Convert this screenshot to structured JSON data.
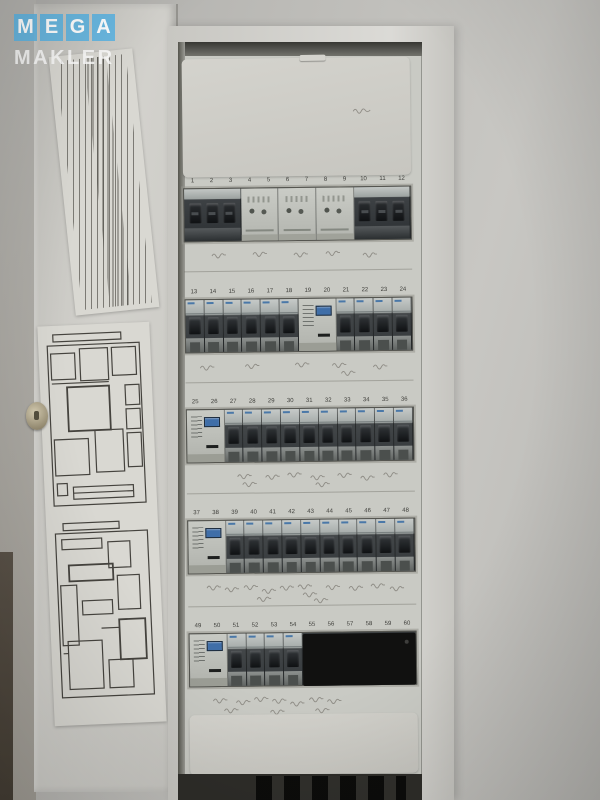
{
  "watermark": {
    "line1": "MEGA",
    "line2": "MAKLER",
    "accent_color": "#61b5e2"
  },
  "panel": {
    "description": "open electrical distribution board with five DIN rows of circuit breakers and meter modules, door with circuit schedule and floor plans",
    "colors": {
      "display_blue": "#3f6ea8",
      "breaker_dark": "#2e3234",
      "cover_gray": "#cfceca"
    },
    "rows": [
      {
        "numbers": [
          "1",
          "2",
          "3",
          "4",
          "5",
          "6",
          "7",
          "8",
          "9",
          "10",
          "11",
          "12"
        ],
        "modules": [
          {
            "type": "breaker3",
            "span": 3
          },
          {
            "type": "meter",
            "span": 2
          },
          {
            "type": "meter",
            "span": 2
          },
          {
            "type": "meter",
            "span": 2
          },
          {
            "type": "breaker3",
            "span": 3
          }
        ]
      },
      {
        "numbers": [
          "13",
          "14",
          "15",
          "16",
          "17",
          "18",
          "19",
          "20",
          "21",
          "22",
          "23",
          "24"
        ],
        "modules": [
          {
            "type": "breaker",
            "span": 1
          },
          {
            "type": "breaker",
            "span": 1
          },
          {
            "type": "breaker",
            "span": 1
          },
          {
            "type": "breaker",
            "span": 1
          },
          {
            "type": "breaker",
            "span": 1
          },
          {
            "type": "breaker",
            "span": 1
          },
          {
            "type": "meter_display",
            "span": 2
          },
          {
            "type": "breaker",
            "span": 1
          },
          {
            "type": "breaker",
            "span": 1
          },
          {
            "type": "breaker",
            "span": 1
          },
          {
            "type": "breaker",
            "span": 1
          }
        ]
      },
      {
        "numbers": [
          "25",
          "26",
          "27",
          "28",
          "29",
          "30",
          "31",
          "32",
          "33",
          "34",
          "35",
          "36"
        ],
        "modules": [
          {
            "type": "meter_display",
            "span": 2
          },
          {
            "type": "breaker",
            "span": 1
          },
          {
            "type": "breaker",
            "span": 1
          },
          {
            "type": "breaker",
            "span": 1
          },
          {
            "type": "breaker",
            "span": 1
          },
          {
            "type": "breaker",
            "span": 1
          },
          {
            "type": "breaker",
            "span": 1
          },
          {
            "type": "breaker",
            "span": 1
          },
          {
            "type": "breaker",
            "span": 1
          },
          {
            "type": "breaker",
            "span": 1
          },
          {
            "type": "breaker",
            "span": 1
          }
        ]
      },
      {
        "numbers": [
          "37",
          "38",
          "39",
          "40",
          "41",
          "42",
          "43",
          "44",
          "45",
          "46",
          "47",
          "48"
        ],
        "modules": [
          {
            "type": "meter_display",
            "span": 2
          },
          {
            "type": "breaker",
            "span": 1
          },
          {
            "type": "breaker",
            "span": 1
          },
          {
            "type": "breaker",
            "span": 1
          },
          {
            "type": "breaker",
            "span": 1
          },
          {
            "type": "breaker",
            "span": 1
          },
          {
            "type": "breaker",
            "span": 1
          },
          {
            "type": "breaker",
            "span": 1
          },
          {
            "type": "breaker",
            "span": 1
          },
          {
            "type": "breaker",
            "span": 1
          },
          {
            "type": "breaker",
            "span": 1
          }
        ]
      },
      {
        "numbers": [
          "49",
          "50",
          "51",
          "52",
          "53",
          "54",
          "55",
          "56",
          "57",
          "58",
          "59",
          "60"
        ],
        "modules": [
          {
            "type": "meter_display",
            "span": 2
          },
          {
            "type": "breaker",
            "span": 1
          },
          {
            "type": "breaker",
            "span": 1
          },
          {
            "type": "breaker",
            "span": 1
          },
          {
            "type": "breaker",
            "span": 1
          },
          {
            "type": "blank",
            "span": 6
          }
        ]
      }
    ]
  }
}
